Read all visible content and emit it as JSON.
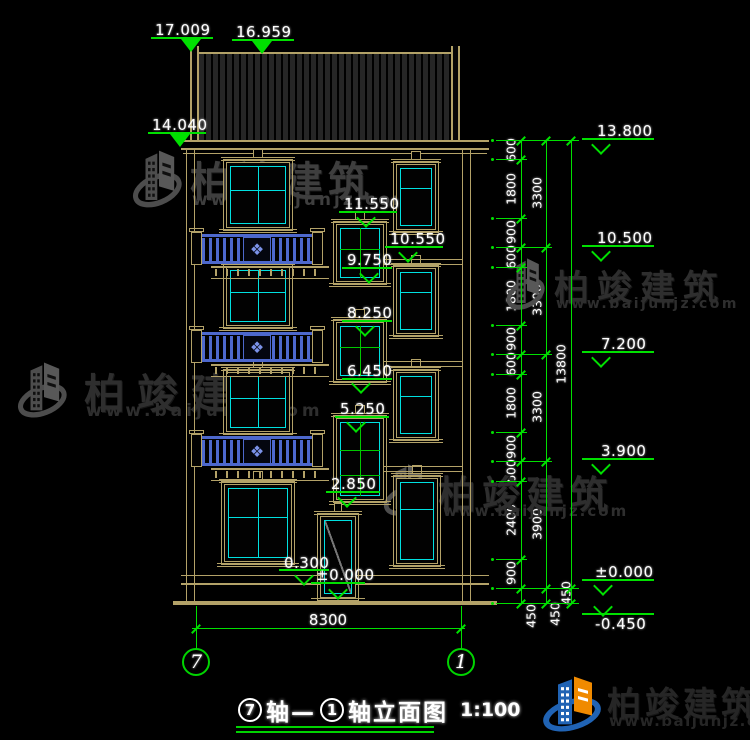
{
  "watermark": {
    "brand": "柏竣建筑",
    "url": "www.baijunjz.com"
  },
  "title": {
    "axis_left": "7",
    "sep": "轴—",
    "axis_right": "1",
    "suffix": "轴立面图",
    "scale": "1:100"
  },
  "axis_bubbles": {
    "left": "7",
    "right": "1"
  },
  "elevations": {
    "roof_ridge": "17.009",
    "roof_edge": "16.959",
    "eave_left": "14.040",
    "mid": [
      "11.550",
      "10.550",
      "9.750",
      "8.250",
      "6.450",
      "5.250",
      "2.850",
      "0.300",
      "±0.000"
    ],
    "right": [
      "13.800",
      "10.500",
      "7.200",
      "3.900",
      "±0.000",
      "-0.450"
    ]
  },
  "dimensions": {
    "inner_chain": [
      "600",
      "1800",
      "900",
      "600",
      "1800",
      "900",
      "600",
      "1800",
      "900",
      "600",
      "2400",
      "900",
      "450"
    ],
    "floor_chain": [
      "3300",
      "3300",
      "3300",
      "3900",
      "450"
    ],
    "total_chain": [
      "13800",
      "450"
    ],
    "width_total": "8300"
  },
  "icons": {
    "balcony_ornament": "❖",
    "logo": "building-swoosh-icon"
  },
  "colors": {
    "background": "#000000",
    "outline_tan": "#b3a268",
    "dimension_green": "#00e000",
    "window_cyan": "#00e0e0",
    "mullion_green": "#00c800",
    "railing_blue": "#4d68cc",
    "watermark_gray": "#3a3a3a",
    "logo_blue": "#2063b4",
    "logo_orange": "#f08a00"
  }
}
